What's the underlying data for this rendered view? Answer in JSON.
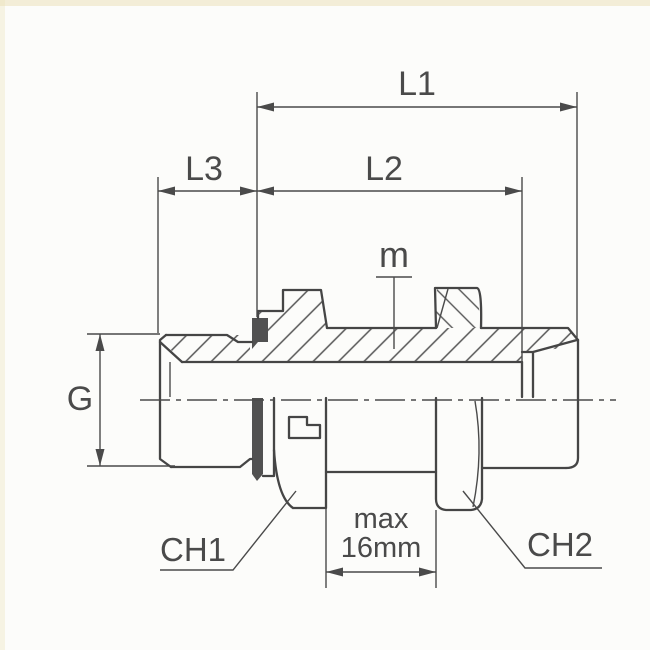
{
  "labels": {
    "l1": "L1",
    "l2": "L2",
    "l3": "L3",
    "g": "G",
    "m": "m",
    "ch1": "CH1",
    "ch2": "CH2",
    "max_width_line1": "max",
    "max_width_line2": "16mm"
  },
  "colors": {
    "line": "#4a4a4a",
    "text": "#4a4a4a",
    "seal_fill": "#515151",
    "background": "#fcfcfa"
  }
}
